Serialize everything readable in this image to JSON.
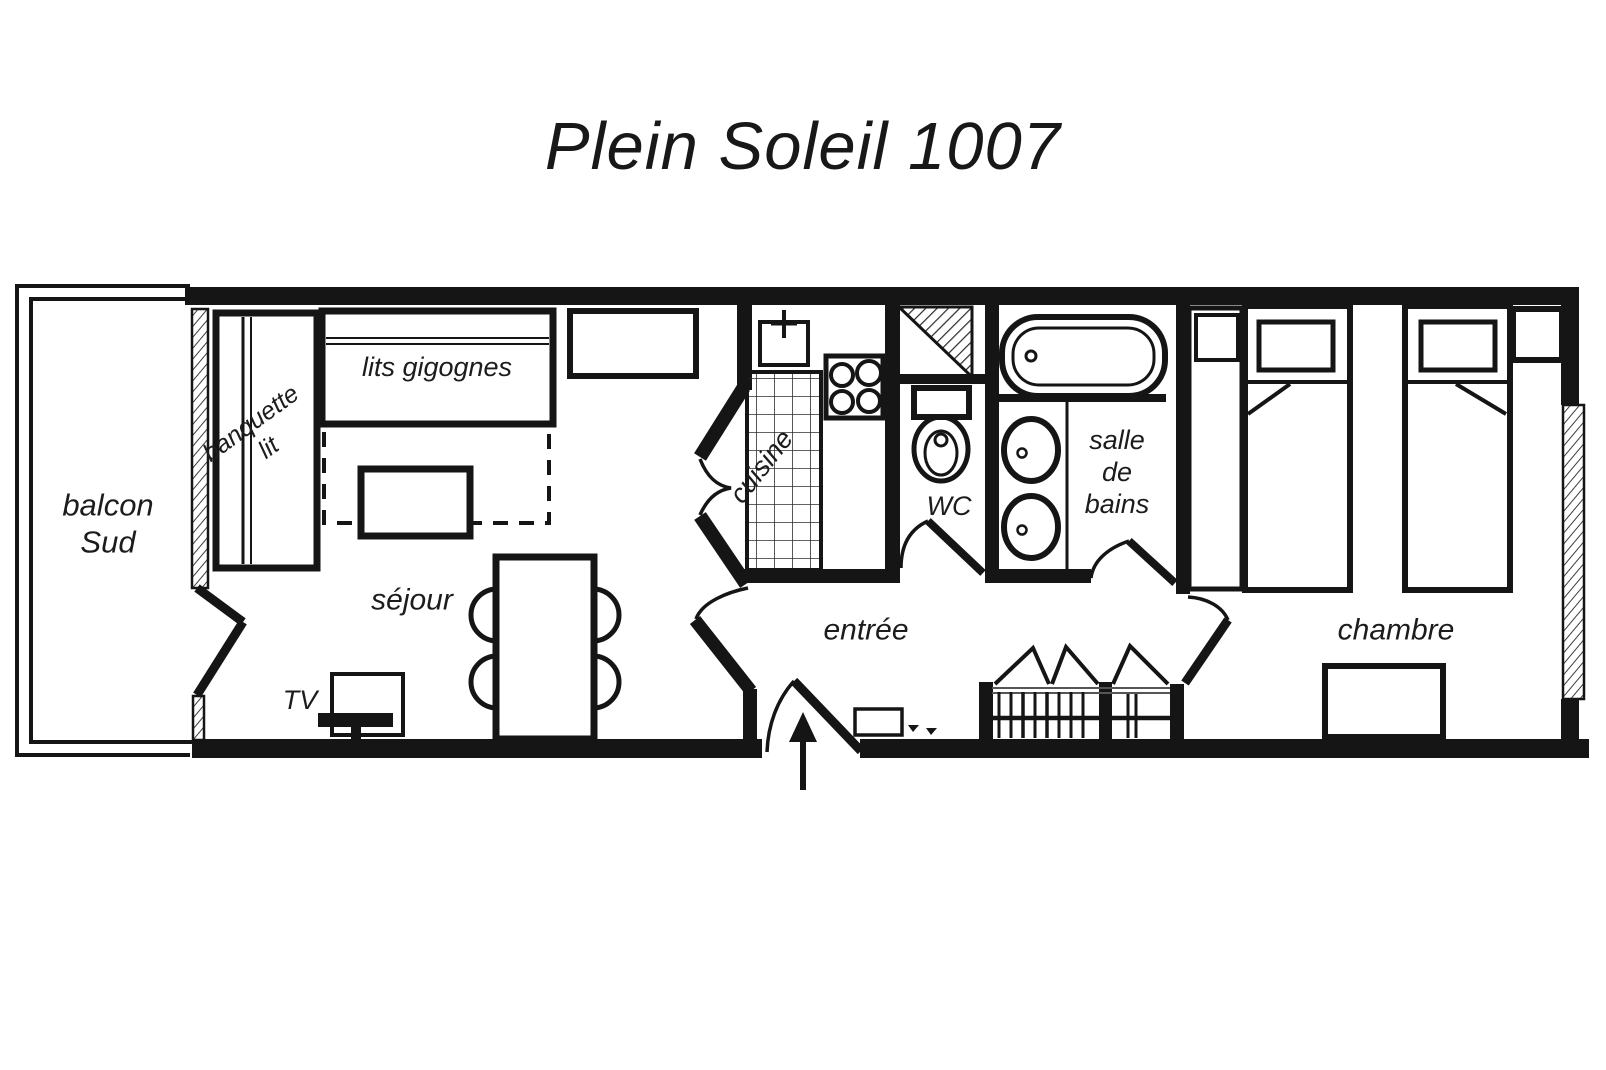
{
  "title": "Plein Soleil 1007",
  "rooms": {
    "balcony": {
      "line1": "balcon",
      "line2": "Sud"
    },
    "living": {
      "label": "séjour"
    },
    "kitchen": {
      "label": "cuisine"
    },
    "wc": {
      "label": "WC"
    },
    "bathroom": {
      "line1": "salle",
      "line2": "de",
      "line3": "bains"
    },
    "entrance": {
      "label": "entrée"
    },
    "bedroom": {
      "label": "chambre"
    }
  },
  "furniture": {
    "trundle_beds": {
      "label": "lits gigognes"
    },
    "bench_bed": {
      "line1": "banquette",
      "line2": "lit"
    },
    "tv": {
      "label": "TV"
    }
  },
  "symbols": [
    "window-hatch",
    "french-doors",
    "swing-door",
    "entry-arrow",
    "sink",
    "stove",
    "tiled-counter",
    "toilet",
    "bathtub",
    "double-basin",
    "closet-hangers",
    "bifold-doors",
    "single-bed",
    "nightstand",
    "dresser",
    "dining-table-chairs",
    "coffee-table",
    "tv-set",
    "doormat"
  ],
  "colors": {
    "wall": "#151515",
    "background": "#ffffff",
    "text": "#1c1c1c"
  }
}
